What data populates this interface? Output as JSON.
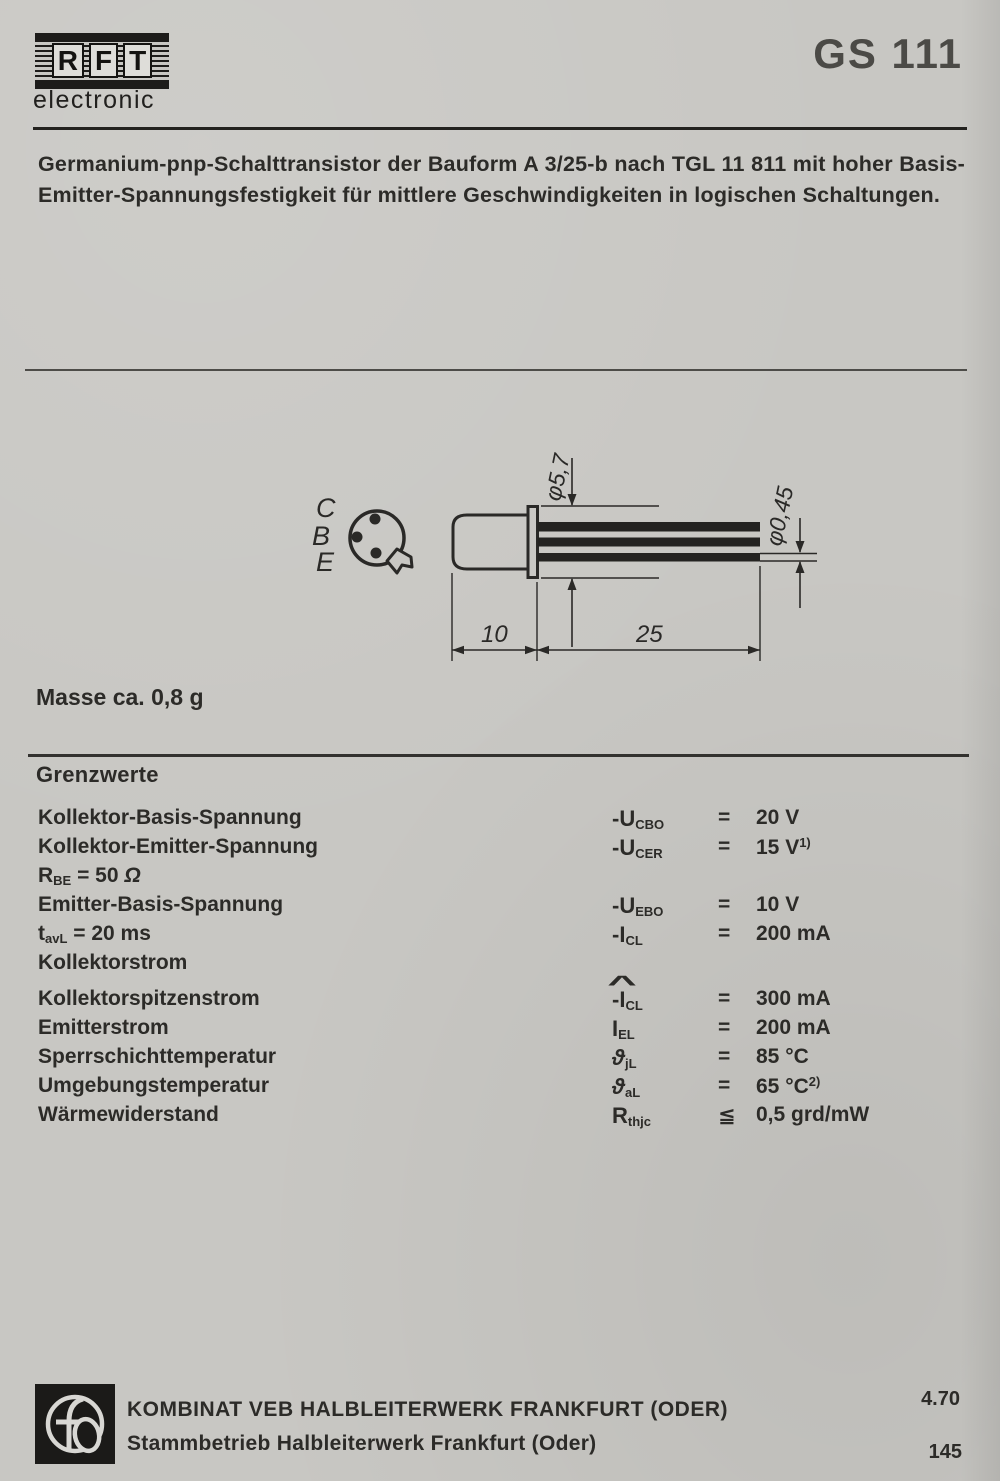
{
  "page": {
    "brand": "RFT",
    "brand_letters": [
      "R",
      "F",
      "T"
    ],
    "brand_sub": "electronic",
    "part_number": "GS 111"
  },
  "colors": {
    "paper": "#c8c7c3",
    "ink": "#2c2b28",
    "part_number_gray": "#4b4a46"
  },
  "description": {
    "line1": "Germanium-pnp-Schalttransistor der Bauform A 3/25-b nach TGL 11 811 mit hoher Basis-",
    "line2": "Emitter-Spannungsfestigkeit für mittlere Geschwindigkeiten in logischen Schaltungen."
  },
  "drawing": {
    "pin_labels": [
      "C",
      "B",
      "E"
    ],
    "dims": {
      "body_diameter": "φ5,7",
      "lead_diameter": "φ0,45",
      "body_length": "10",
      "lead_length": "25"
    }
  },
  "mass_note": "Masse ca. 0,8 g",
  "limits": {
    "title": "Grenzwerte",
    "rows": [
      {
        "label": [
          {
            "t": "Kollektor-Basis-Spannung"
          }
        ],
        "symbol": [
          {
            "t": "-U"
          },
          {
            "s": "CBO"
          }
        ],
        "rel": "=",
        "value": [
          {
            "t": "20 V"
          }
        ]
      },
      {
        "label": [
          {
            "t": "Kollektor-Emitter-Spannung"
          }
        ],
        "symbol": [
          {
            "t": "-U"
          },
          {
            "s": "CER"
          }
        ],
        "rel": "=",
        "value": [
          {
            "t": "15 V"
          },
          {
            "p": "1)"
          }
        ]
      },
      {
        "label": [
          {
            "t": "R"
          },
          {
            "s": "BE"
          },
          {
            "t": " = 50 "
          },
          {
            "it": "Ω"
          }
        ],
        "symbol": null,
        "rel": null,
        "value": null
      },
      {
        "label": [
          {
            "t": "Emitter-Basis-Spannung"
          }
        ],
        "symbol": [
          {
            "t": "-U"
          },
          {
            "s": "EBO"
          }
        ],
        "rel": "=",
        "value": [
          {
            "t": "10 V"
          }
        ]
      },
      {
        "label": [
          {
            "t": "t"
          },
          {
            "s": "avL"
          },
          {
            "t": " = 20 ms"
          }
        ],
        "symbol": [
          {
            "t": "-I"
          },
          {
            "s": "CL"
          }
        ],
        "rel": "=",
        "value": [
          {
            "t": "200 mA"
          }
        ]
      },
      {
        "label": [
          {
            "t": "Kollektorstrom"
          }
        ],
        "symbol": null,
        "rel": null,
        "value": null
      },
      {
        "label": [
          {
            "t": "Kollektorspitzenstrom"
          }
        ],
        "symbol": [
          {
            "t": "-"
          },
          {
            "hat": "I"
          },
          {
            "s": "CL"
          }
        ],
        "rel": "=",
        "value": [
          {
            "t": "300 mA"
          }
        ]
      },
      {
        "label": [
          {
            "t": "Emitterstrom"
          }
        ],
        "symbol": [
          {
            "t": "I"
          },
          {
            "s": "EL"
          }
        ],
        "rel": "=",
        "value": [
          {
            "t": "200 mA"
          }
        ]
      },
      {
        "label": [
          {
            "t": "Sperrschichttemperatur"
          }
        ],
        "symbol": [
          {
            "it": "ϑ"
          },
          {
            "s": "jL"
          }
        ],
        "rel": "=",
        "value": [
          {
            "t": "85 °C"
          }
        ]
      },
      {
        "label": [
          {
            "t": "Umgebungstemperatur"
          }
        ],
        "symbol": [
          {
            "it": "ϑ"
          },
          {
            "s": "aL"
          }
        ],
        "rel": "=",
        "value": [
          {
            "t": "65 °C"
          },
          {
            "p": "2)"
          }
        ]
      },
      {
        "label": [
          {
            "t": "Wärmewiderstand"
          }
        ],
        "symbol": [
          {
            "t": "R"
          },
          {
            "s": "thjc"
          }
        ],
        "rel": "≦",
        "value": [
          {
            "t": "0,5 grd/mW"
          }
        ]
      }
    ]
  },
  "footer": {
    "line1": "KOMBINAT VEB HALBLEITERWERK FRANKFURT (ODER)",
    "line2": "Stammbetrieb Halbleiterwerk Frankfurt (Oder)",
    "date": "4.70",
    "page_number": "145"
  }
}
